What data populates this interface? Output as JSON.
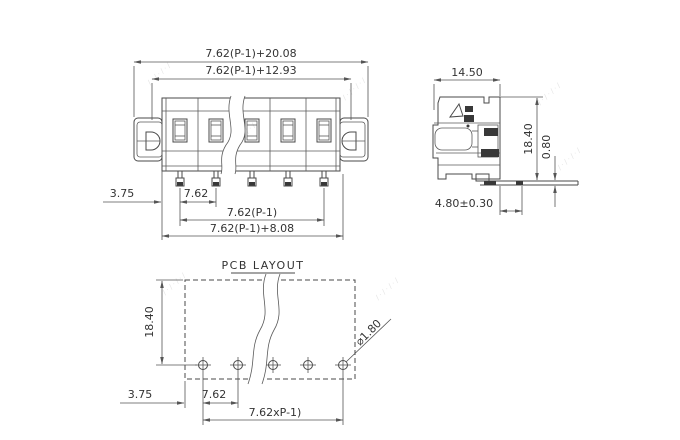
{
  "views": {
    "front": {
      "dim_overall_width": "7.62(P-1)+20.08",
      "dim_inner_width": "7.62(P-1)+12.93",
      "dim_edge_to_pin": "3.75",
      "dim_pitch": "7.62",
      "dim_pin_span": "7.62(P-1)",
      "dim_body_width": "7.62(P-1)+8.08"
    },
    "side": {
      "dim_depth": "14.50",
      "dim_height": "18.40",
      "dim_pin_thickness": "0.80",
      "dim_pin_length": "4.80±0.30"
    },
    "pcb": {
      "title": "PCB LAYOUT",
      "dim_row_offset": "18.40",
      "dim_edge_to_hole": "3.75",
      "dim_hole_pitch": "7.62",
      "dim_hole_span": "7.62xP-1)",
      "dim_hole_diameter": "⌀1.80"
    }
  },
  "watermark": {
    "text": "/·/·/·/",
    "color": "#e4e4e4"
  }
}
